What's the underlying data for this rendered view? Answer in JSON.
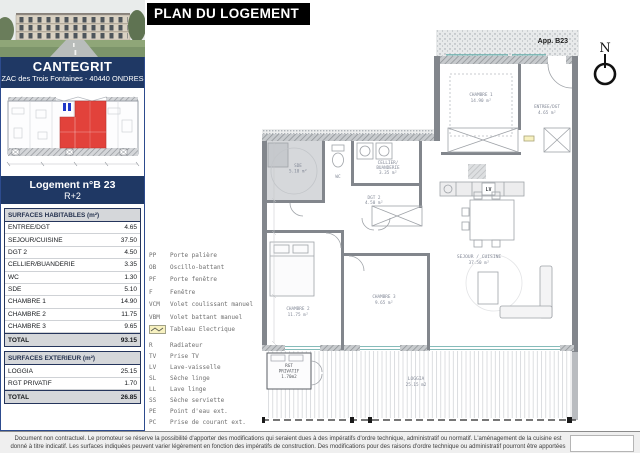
{
  "header": {
    "title": "PLAN DU LOGEMENT"
  },
  "project": {
    "name": "CANTEGRIT",
    "address": "ZAC des Trois Fontaines - 40440 ONDRES"
  },
  "unit": {
    "title": "Logement n°B 23",
    "floor": "R+2",
    "plan_label": "App. B23"
  },
  "north": {
    "label": "N"
  },
  "colors": {
    "banner_navy": "#1f3864",
    "highlight_red": "#e2423b",
    "title_black": "#000000",
    "table_header_grey": "#d5d7da"
  },
  "surfaces_habitables": {
    "header": "SURFACES HABITABLES (m²)",
    "rows": [
      {
        "label": "ENTREE/DGT",
        "value": "4.65"
      },
      {
        "label": "SEJOUR/CUISINE",
        "value": "37.50"
      },
      {
        "label": "DGT 2",
        "value": "4.50"
      },
      {
        "label": "CELLIER/BUANDERIE",
        "value": "3.35"
      },
      {
        "label": "WC",
        "value": "1.30"
      },
      {
        "label": "SDE",
        "value": "5.10"
      },
      {
        "label": "CHAMBRE 1",
        "value": "14.90"
      },
      {
        "label": "CHAMBRE 2",
        "value": "11.75"
      },
      {
        "label": "CHAMBRE 3",
        "value": "9.65"
      }
    ],
    "total_label": "TOTAL",
    "total_value": "93.15"
  },
  "surfaces_exterieur": {
    "header": "SURFACES EXTERIEUR (m²)",
    "rows": [
      {
        "label": "LOGGIA",
        "value": "25.15"
      },
      {
        "label": "RGT PRIVATIF",
        "value": "1.70"
      }
    ],
    "total_label": "TOTAL",
    "total_value": "26.85"
  },
  "legend": {
    "items": [
      {
        "key": "PP",
        "label": "Porte palière"
      },
      {
        "key": "OB",
        "label": "Oscillo-battant"
      },
      {
        "key": "PF",
        "label": "Porte fenêtre"
      },
      {
        "key": "F",
        "label": "Fenêtre"
      },
      {
        "key": "VCM",
        "label": "Volet coulissant manuel"
      },
      {
        "key": "VBM",
        "label": "Volet battant manuel"
      },
      {
        "key": "",
        "label": "Tableau Electrique"
      },
      {
        "key": "R",
        "label": "Radiateur"
      },
      {
        "key": "TV",
        "label": "Prise TV"
      },
      {
        "key": "LV",
        "label": "Lave-vaisselle"
      },
      {
        "key": "SL",
        "label": "Sèche linge"
      },
      {
        "key": "LL",
        "label": "Lave linge"
      },
      {
        "key": "SS",
        "label": "Sèche serviette"
      },
      {
        "key": "PE",
        "label": "Point d'eau ext."
      },
      {
        "key": "PC",
        "label": "Prise de courant ext."
      }
    ]
  },
  "plan": {
    "rooms": {
      "sde1": "SDE",
      "sde2": "5.10 m²",
      "wc": "WC",
      "cellier1": "CELLIER/",
      "cellier2": "BUANDERIE",
      "cellier3": "3.35 m²",
      "dgt1": "DGT 2",
      "dgt2": "4.50 m²",
      "ch1a": "CHAMBRE 1",
      "ch1b": "14.90 m²",
      "entree1": "ENTREE/DGT",
      "entree2": "4.65 m²",
      "sejour1": "SEJOUR / CUISINE",
      "sejour2": "37.50 m²",
      "ch2a": "CHAMBRE 2",
      "ch2b": "11.75 m²",
      "ch3a": "CHAMBRE 3",
      "ch3b": "9.65 m²",
      "loggia1": "LOGGIA",
      "loggia2": "25.15 m2",
      "rgt1": "RGT",
      "rgt2": "PRIVATIF",
      "rgt3": "1.70m2",
      "lv": "LV"
    }
  },
  "footer": {
    "disclaimer": "Document non contractuel. Le promoteur se réserve la possibilité d'apporter des modifications qui seraient dues à des impératifs d'ordre technique, administratif ou normatif. L'aménagement de la cuisine est donné à titre indicatif. Les surfaces indiquées peuvent varier légèrement en fonction des impératifs de construction. Des modifications pour des raisons d'ordre technique ou administratif pourront être apportées sur les plans. Seuls les plans déposés au rang des minutes du notaire font foi."
  }
}
